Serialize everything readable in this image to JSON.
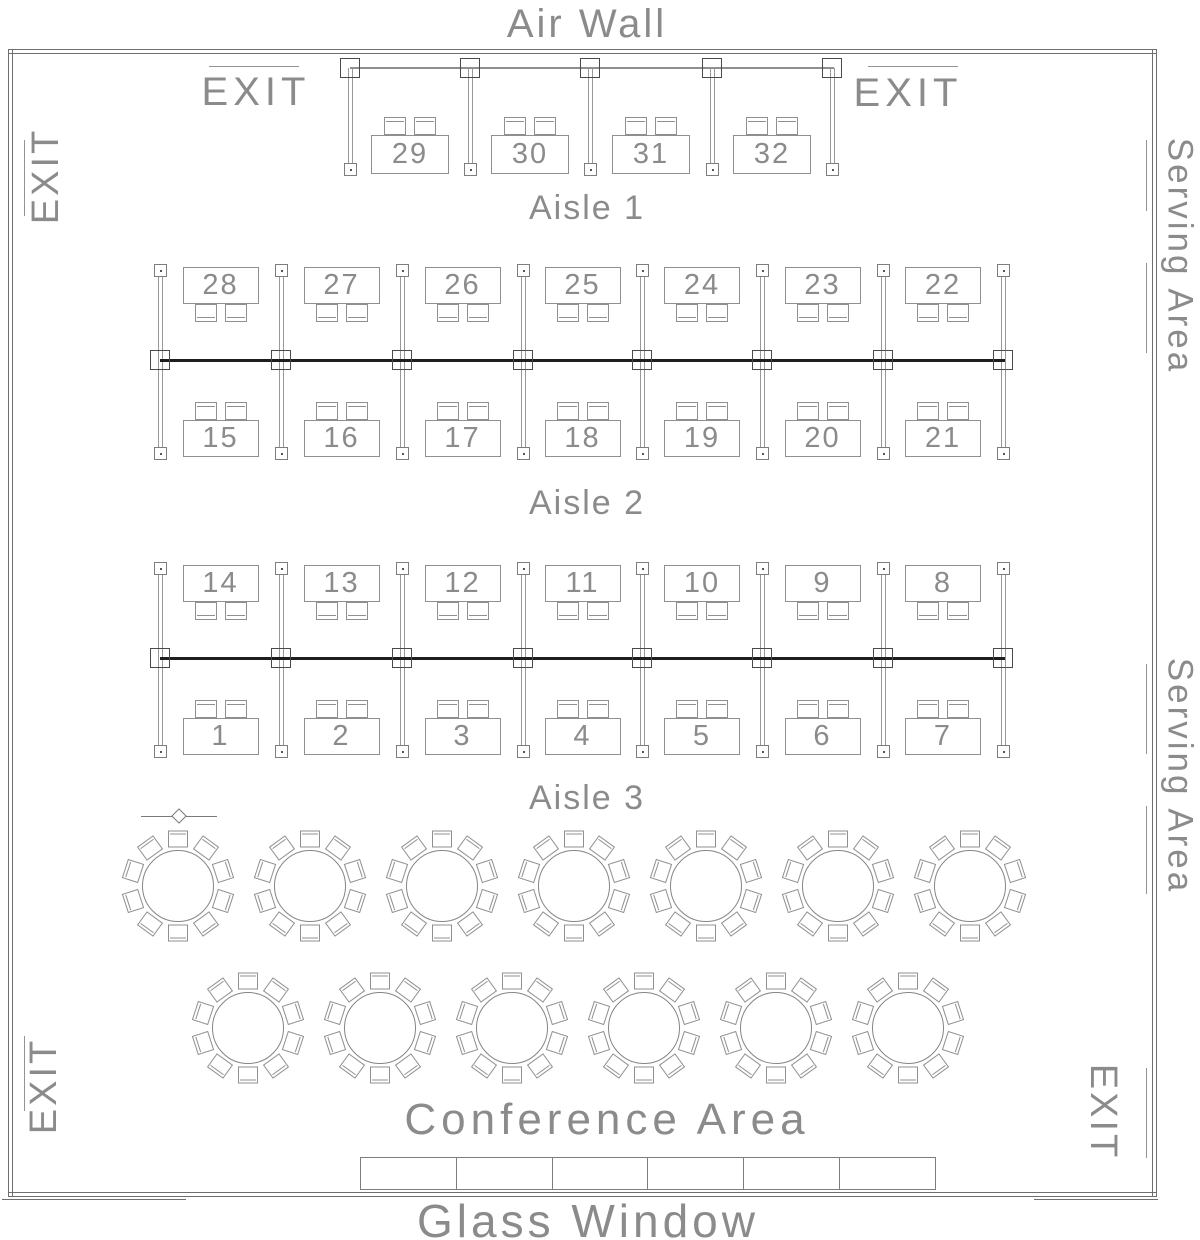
{
  "labels": {
    "air_wall": "Air Wall",
    "exit": "EXIT",
    "serving_area": "Serving Area",
    "aisle_1": "Aisle 1",
    "aisle_2": "Aisle 2",
    "aisle_3": "Aisle 3",
    "conference_area": "Conference Area",
    "glass_window": "Glass Window"
  },
  "booths": {
    "top_row": [
      "29",
      "30",
      "31",
      "32"
    ],
    "aisle1_top": [
      "28",
      "27",
      "26",
      "25",
      "24",
      "23",
      "22"
    ],
    "aisle1_bottom": [
      "15",
      "16",
      "17",
      "18",
      "19",
      "20",
      "21"
    ],
    "aisle2_top": [
      "14",
      "13",
      "12",
      "11",
      "10",
      "9",
      "8"
    ],
    "aisle2_bottom": [
      "1",
      "2",
      "3",
      "4",
      "5",
      "6",
      "7"
    ]
  },
  "round_tables": {
    "row1_count": 7,
    "row2_count": 6,
    "seats_per_table": 10
  },
  "head_table": {
    "sections": 6
  },
  "colors": {
    "wall_line": "#6e6e6e",
    "furniture_line": "#8f8f8f",
    "rail": "#1e1e1e",
    "text": "#8b8b8b",
    "background": "#ffffff"
  }
}
